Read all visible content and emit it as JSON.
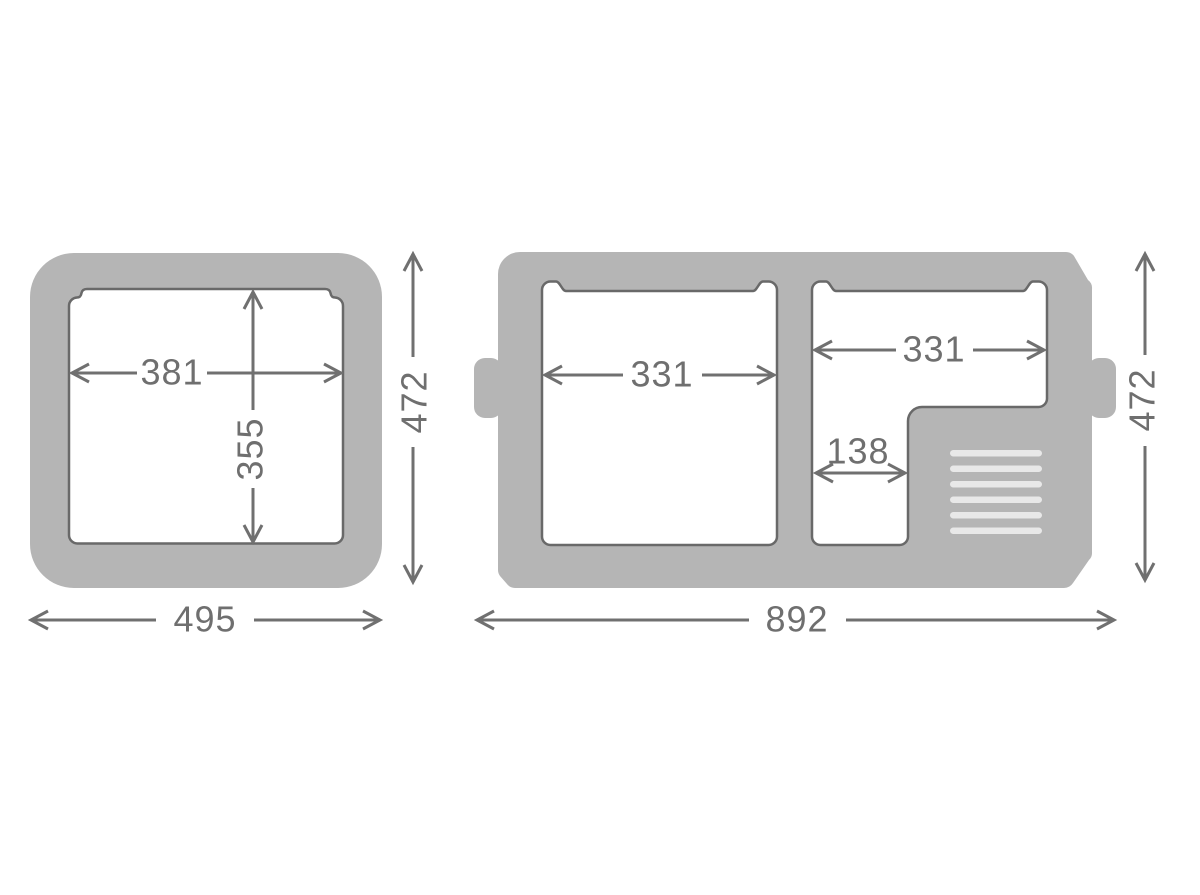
{
  "diagram": {
    "type": "technical-dimension-drawing",
    "colors": {
      "body_gray": "#b5b5b5",
      "cavity_outline": "#696969",
      "dimension_gray": "#707070",
      "label_gray": "#6f6f6f",
      "vent_slat": "#e8e8e8",
      "background": "#ffffff"
    },
    "left_view": {
      "inner_width": "381",
      "inner_depth": "355",
      "outer_width": "495",
      "outer_height": "472"
    },
    "right_view": {
      "left_compartment_width": "331",
      "right_compartment_width": "331",
      "narrow_section_width": "138",
      "outer_width": "892",
      "outer_height": "472",
      "vent_slat_count": 6
    }
  }
}
